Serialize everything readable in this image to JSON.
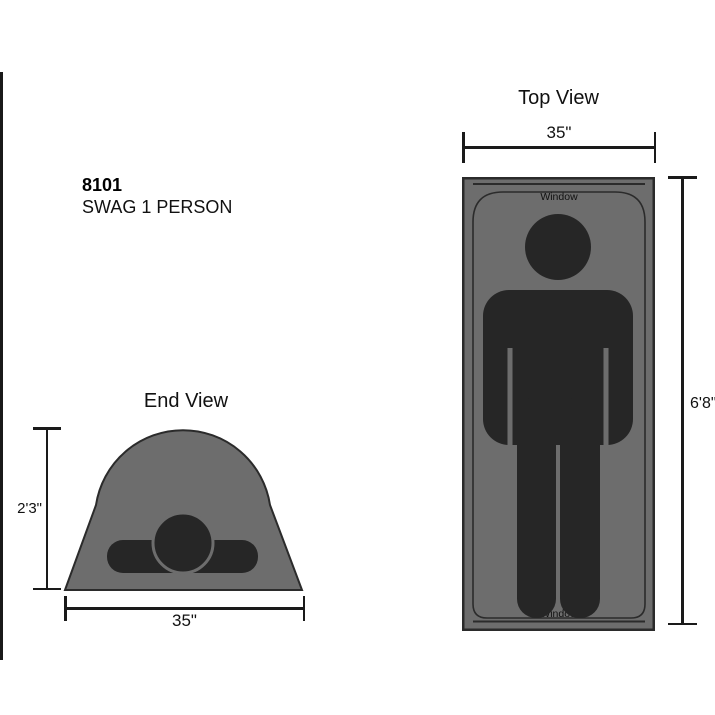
{
  "product": {
    "code": "8101",
    "name": "SWAG 1 PERSON"
  },
  "top_view": {
    "title": "Top View",
    "width_label": "35\"",
    "height_label": "6'8\"",
    "window_top_label": "Window",
    "window_bottom_label": "Window"
  },
  "end_view": {
    "title": "End View",
    "width_label": "35\"",
    "height_label": "2'3\""
  },
  "colors": {
    "background": "#ffffff",
    "tent_fill": "#6d6d6d",
    "tent_outline": "#2b2b2b",
    "person_fill": "#262626",
    "dimension_line": "#1a1a1a",
    "text": "#111111"
  }
}
